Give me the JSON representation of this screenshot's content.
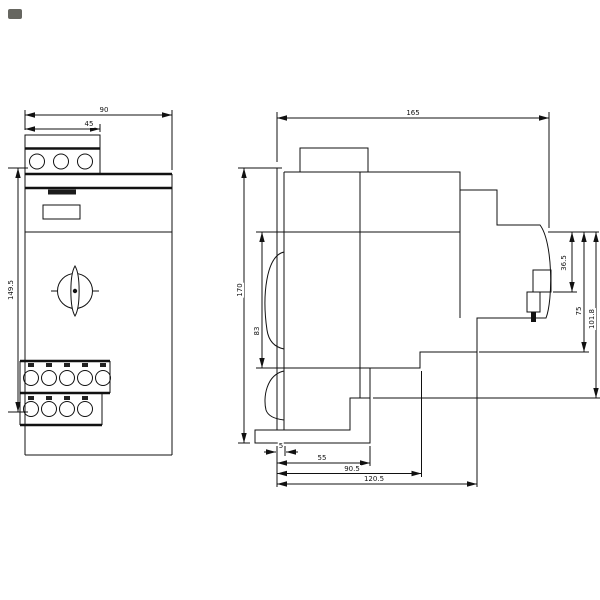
{
  "front": {
    "dims": {
      "width_total": "90",
      "terminal_block_width": "45",
      "height": "149.5"
    }
  },
  "side": {
    "dims": {
      "depth_total": "165",
      "height_total": "170",
      "height_mid": "83",
      "knob_depth": "36.5",
      "mid_depth": "75",
      "body_depth": "101.8",
      "rail_offset": "5",
      "step_1": "55",
      "step_2": "90.5",
      "step_3": "120.5"
    }
  }
}
